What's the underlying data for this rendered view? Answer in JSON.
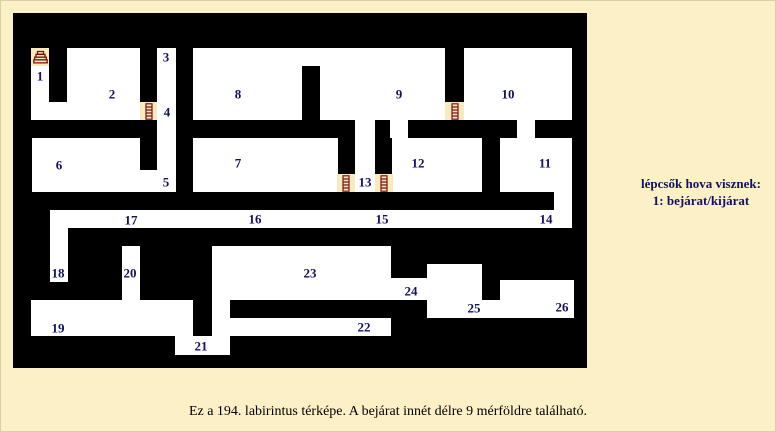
{
  "colors": {
    "page_bg": "#FBF0C6",
    "map_bg": "#000000",
    "room_fill": "#FFFFFF",
    "stair_cell_fill": "#F7EBBE",
    "label_color": "#12125E",
    "icon_color": "#7B120E",
    "caption_color": "#000000"
  },
  "legend": {
    "line1": "lépcsők hova visznek:",
    "line2": "1: bejárat/kijárat"
  },
  "caption": "Ez a 194. labirintus térképe. A bejárat innét délre 9 mérföldre található.",
  "map": {
    "x": 13,
    "y": 13,
    "width": 574,
    "height": 355,
    "rooms": [
      {
        "x": 31,
        "y": 66,
        "w": 18,
        "h": 54
      },
      {
        "x": 49,
        "y": 102,
        "w": 18,
        "h": 18
      },
      {
        "x": 67,
        "y": 48,
        "w": 73,
        "h": 72
      },
      {
        "x": 157,
        "y": 48,
        "w": 19,
        "h": 144
      },
      {
        "x": 140,
        "y": 170,
        "w": 17,
        "h": 22
      },
      {
        "x": 32,
        "y": 138,
        "w": 108,
        "h": 54
      },
      {
        "x": 193,
        "y": 48,
        "w": 252,
        "h": 72
      },
      {
        "x": 464,
        "y": 48,
        "w": 108,
        "h": 72
      },
      {
        "x": 517,
        "y": 120,
        "w": 18,
        "h": 18
      },
      {
        "x": 500,
        "y": 138,
        "w": 72,
        "h": 54
      },
      {
        "x": 392,
        "y": 138,
        "w": 90,
        "h": 54
      },
      {
        "x": 390,
        "y": 120,
        "w": 18,
        "h": 18
      },
      {
        "x": 355,
        "y": 120,
        "w": 20,
        "h": 72
      },
      {
        "x": 193,
        "y": 138,
        "w": 145,
        "h": 54
      },
      {
        "x": 554,
        "y": 192,
        "w": 18,
        "h": 18
      },
      {
        "x": 50,
        "y": 210,
        "w": 522,
        "h": 18
      },
      {
        "x": 50,
        "y": 228,
        "w": 18,
        "h": 54
      },
      {
        "x": 122,
        "y": 246,
        "w": 18,
        "h": 54
      },
      {
        "x": 212,
        "y": 246,
        "w": 179,
        "h": 54
      },
      {
        "x": 212,
        "y": 300,
        "w": 18,
        "h": 36
      },
      {
        "x": 391,
        "y": 278,
        "w": 36,
        "h": 22
      },
      {
        "x": 427,
        "y": 264,
        "w": 55,
        "h": 36
      },
      {
        "x": 500,
        "y": 280,
        "w": 74,
        "h": 20
      },
      {
        "x": 427,
        "y": 300,
        "w": 147,
        "h": 18
      },
      {
        "x": 31,
        "y": 300,
        "w": 162,
        "h": 36
      },
      {
        "x": 175,
        "y": 336,
        "w": 55,
        "h": 19
      },
      {
        "x": 230,
        "y": 318,
        "w": 161,
        "h": 18
      }
    ],
    "wall_patches": [
      {
        "x": 302,
        "y": 66,
        "w": 18,
        "h": 54
      }
    ],
    "stair_cells": [
      {
        "x": 31,
        "y": 48,
        "w": 18,
        "h": 18,
        "icon": "stairs"
      },
      {
        "x": 140,
        "y": 102,
        "w": 17,
        "h": 18,
        "icon": "ladder"
      },
      {
        "x": 445,
        "y": 102,
        "w": 19,
        "h": 18,
        "icon": "ladder"
      },
      {
        "x": 337,
        "y": 174,
        "w": 18,
        "h": 18,
        "icon": "ladder"
      },
      {
        "x": 375,
        "y": 174,
        "w": 18,
        "h": 18,
        "icon": "ladder"
      }
    ],
    "labels": [
      {
        "n": "1",
        "x": 40,
        "y": 76
      },
      {
        "n": "2",
        "x": 112,
        "y": 94
      },
      {
        "n": "3",
        "x": 166,
        "y": 57
      },
      {
        "n": "4",
        "x": 167,
        "y": 112
      },
      {
        "n": "5",
        "x": 166,
        "y": 182
      },
      {
        "n": "6",
        "x": 59,
        "y": 165
      },
      {
        "n": "7",
        "x": 238,
        "y": 163
      },
      {
        "n": "8",
        "x": 238,
        "y": 94
      },
      {
        "n": "9",
        "x": 399,
        "y": 94
      },
      {
        "n": "10",
        "x": 508,
        "y": 94
      },
      {
        "n": "11",
        "x": 545,
        "y": 163
      },
      {
        "n": "12",
        "x": 418,
        "y": 163
      },
      {
        "n": "13",
        "x": 365,
        "y": 182
      },
      {
        "n": "14",
        "x": 546,
        "y": 219
      },
      {
        "n": "15",
        "x": 382,
        "y": 219
      },
      {
        "n": "16",
        "x": 255,
        "y": 219
      },
      {
        "n": "17",
        "x": 131,
        "y": 220
      },
      {
        "n": "18",
        "x": 58,
        "y": 273
      },
      {
        "n": "19",
        "x": 58,
        "y": 328
      },
      {
        "n": "20",
        "x": 130,
        "y": 273
      },
      {
        "n": "21",
        "x": 201,
        "y": 346
      },
      {
        "n": "22",
        "x": 364,
        "y": 327
      },
      {
        "n": "23",
        "x": 310,
        "y": 273
      },
      {
        "n": "24",
        "x": 411,
        "y": 291
      },
      {
        "n": "25",
        "x": 474,
        "y": 308
      },
      {
        "n": "26",
        "x": 562,
        "y": 307
      }
    ]
  }
}
